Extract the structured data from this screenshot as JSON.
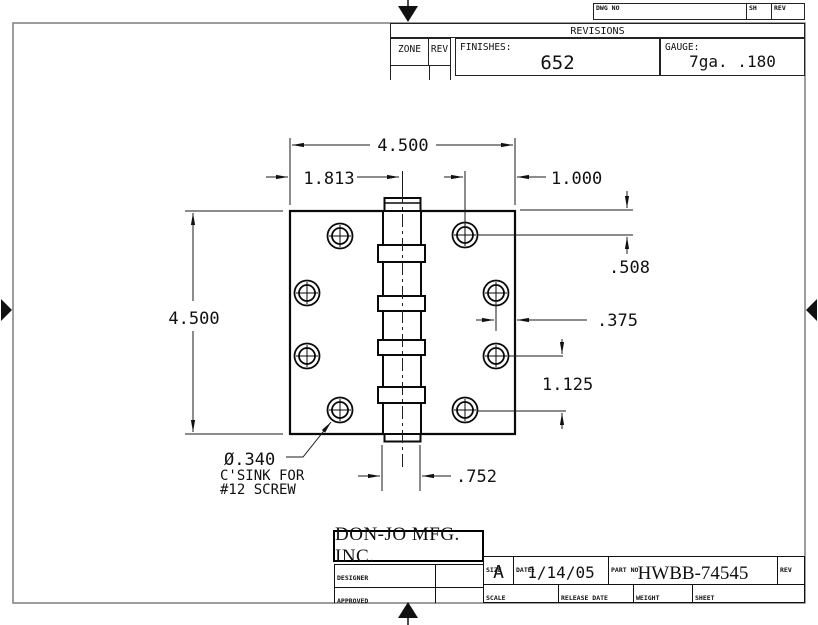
{
  "sheet": {
    "top_strip": {
      "dwg_no": "DWG NO",
      "sh": "SH",
      "rev": "REV"
    },
    "revisions": {
      "title": "REVISIONS",
      "zone": "ZONE",
      "rev": "REV",
      "finishes_label": "FINISHES:",
      "finishes_value": "652",
      "gauge_label": "GAUGE:",
      "gauge_value": "7ga. .180"
    },
    "dims": {
      "overall_width": "4.500",
      "left_offset": "1.813",
      "right_offset": "1.000",
      "overall_height": "4.500",
      "top_hole_offset": ".508",
      "edge_offset": ".375",
      "hole_spacing": "1.125",
      "knuckle_width": ".752"
    },
    "note": {
      "line1": "Ø.340",
      "line2": "C'SINK FOR",
      "line3": "#12 SCREW"
    },
    "title_block": {
      "company": "DON-JO MFG. INC.",
      "designer": "DESIGNER",
      "approved": "APPROVED",
      "size_label": "SIZE",
      "size_value": "A",
      "date_label": "DATE:",
      "date_value": "1/14/05",
      "part_label": "PART NO.",
      "part_value": "HWBB-74545",
      "rev_label": "REV",
      "scale_label": "SCALE",
      "release_label": "RELEASE DATE",
      "weight_label": "WEIGHT",
      "sheet_label": "SHEET"
    }
  }
}
